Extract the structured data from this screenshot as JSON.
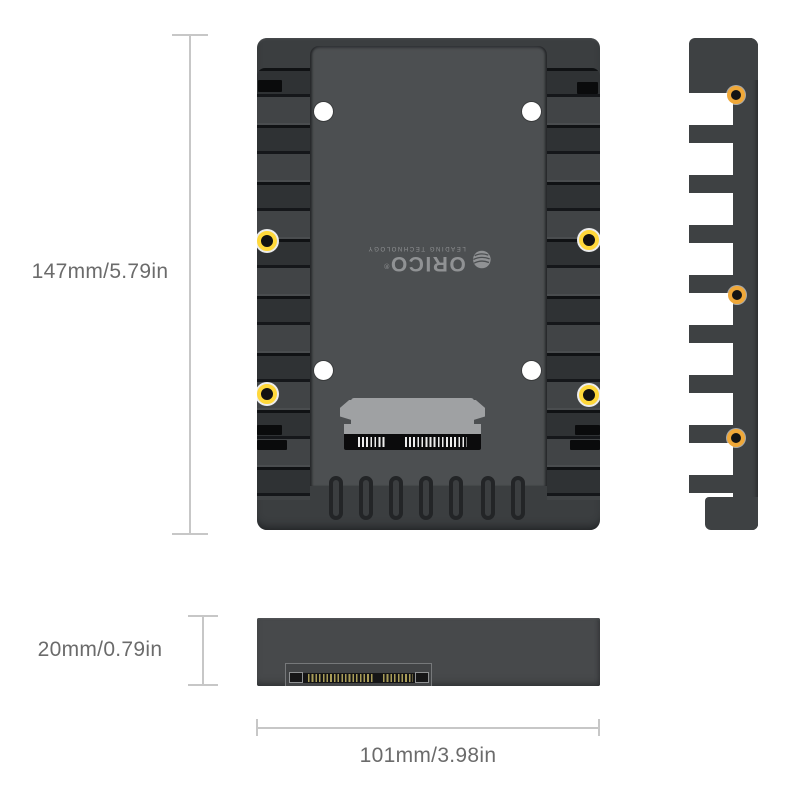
{
  "product": {
    "brand": "ORICO",
    "reg_mark": "®",
    "tagline": "LEADING TECHNOLOGY"
  },
  "dimensions": {
    "height_label": "147mm/5.79in",
    "thickness_label": "20mm/0.79in",
    "width_label": "101mm/3.98in"
  },
  "colors": {
    "background": "#ffffff",
    "body_dark": "#3b3e40",
    "panel": "#4c4f51",
    "connector_gray": "#9fa1a3",
    "screw_gold_front": "#ffd83a",
    "screw_gold_side": "#f0a838",
    "dimension_line": "#c7c7c7",
    "dimension_text": "#6b6b6b"
  }
}
